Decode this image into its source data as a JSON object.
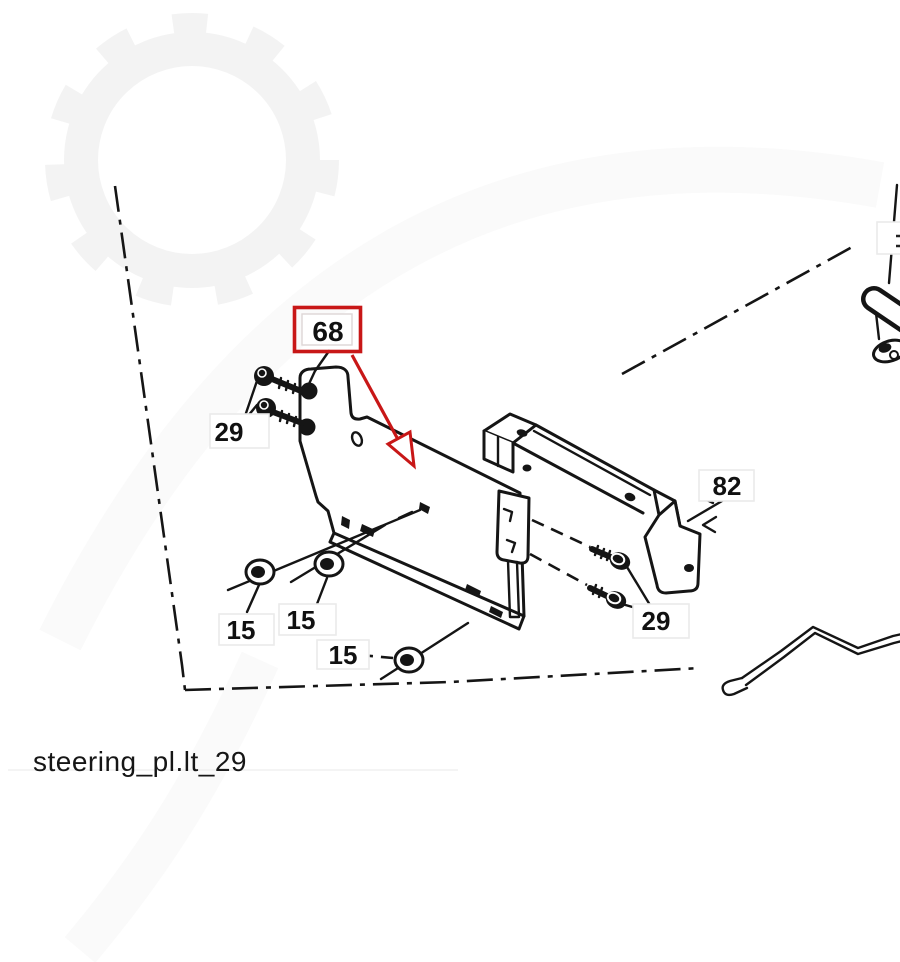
{
  "footer": {
    "filename": "steering_pl.lt_29"
  },
  "colors": {
    "highlight_red": "#c81717",
    "line_black": "#151515",
    "label_box_border": "#eaeaea",
    "watermark_gray": "#f3f3f3"
  },
  "callouts": {
    "part68": {
      "label": "68",
      "highlighted": true
    },
    "part29_left": {
      "label": "29"
    },
    "part15_a": {
      "label": "15"
    },
    "part15_b": {
      "label": "15"
    },
    "part15_c": {
      "label": "15"
    },
    "part29_right": {
      "label": "29"
    },
    "part82": {
      "label": "82"
    }
  }
}
